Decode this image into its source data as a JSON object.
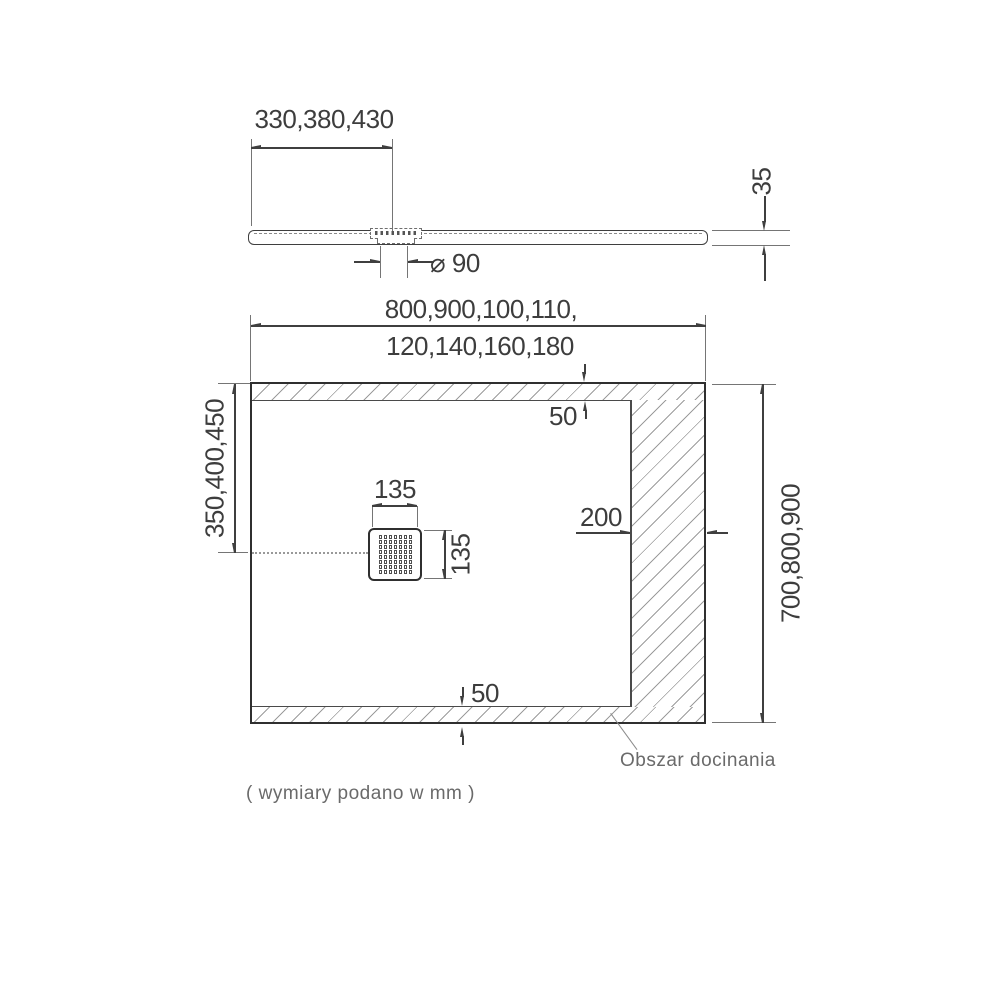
{
  "title": "shower-tray-technical-drawing",
  "side_view": {
    "drain_offset_dim": "330,380,430",
    "thickness_dim": "35",
    "drain_diameter_dim": "⌀ 90"
  },
  "plan_view": {
    "width_dim_line1": "800,900,100,110,",
    "width_dim_line2": "120,140,160,180",
    "drain_center_dim": "350,400,450",
    "depth_dim": "700,800,900",
    "drain_width_dim": "135",
    "drain_height_dim": "135",
    "right_trim_dim": "200",
    "top_trim_dim": "50",
    "bottom_trim_dim": "50",
    "trim_area_label": "Obszar docinania"
  },
  "footer": {
    "units_note": "( wymiary podano w mm )"
  },
  "colors": {
    "line": "#3f3f3f",
    "thinline": "#757575",
    "hatch": "#9c9c9c",
    "text": "#3d3d3d",
    "caption": "#6a6a6a"
  }
}
